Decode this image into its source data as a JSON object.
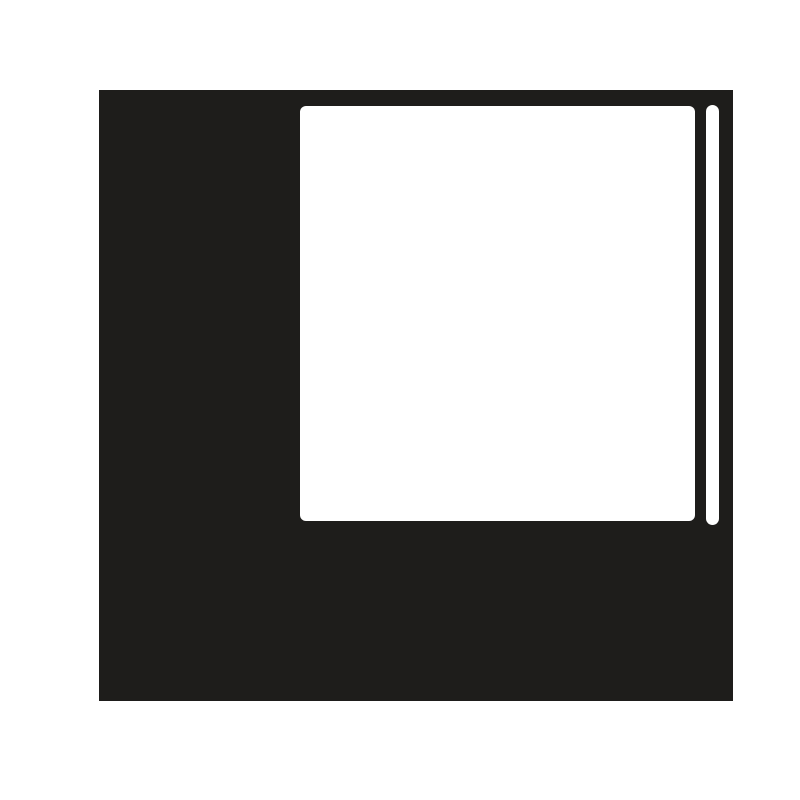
{
  "colors": {
    "page_bg": "#ffffff",
    "panel_bg": "#1e1d1b",
    "content_bg": "#ffffff",
    "scrollbar_bg": "#ffffff"
  },
  "shapes": {
    "dark_panel": "solid dark square backdrop",
    "content_area": "white rounded content panel",
    "scrollbar_thumb": "white vertical pill-shaped scrollbar thumb"
  }
}
